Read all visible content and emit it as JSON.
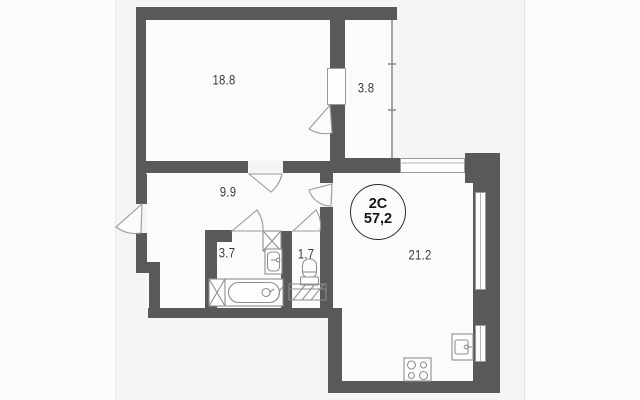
{
  "badge": {
    "type": "2C",
    "area": "57,2"
  },
  "rooms": {
    "living": {
      "area": "18.8"
    },
    "balcony": {
      "area": "3.8"
    },
    "hall": {
      "area": "9.9"
    },
    "bathroom": {
      "area": "3.7"
    },
    "wc": {
      "area": "1.7"
    },
    "kitchen": {
      "area": "21.2"
    }
  },
  "colors": {
    "wall": "#595959",
    "fixture_line": "#8f8f8f",
    "room_fill": "#fbfbfb",
    "background_band": "#f5f5f6",
    "label_text": "#3a3a3a",
    "badge_border": "#2b2b2b"
  }
}
